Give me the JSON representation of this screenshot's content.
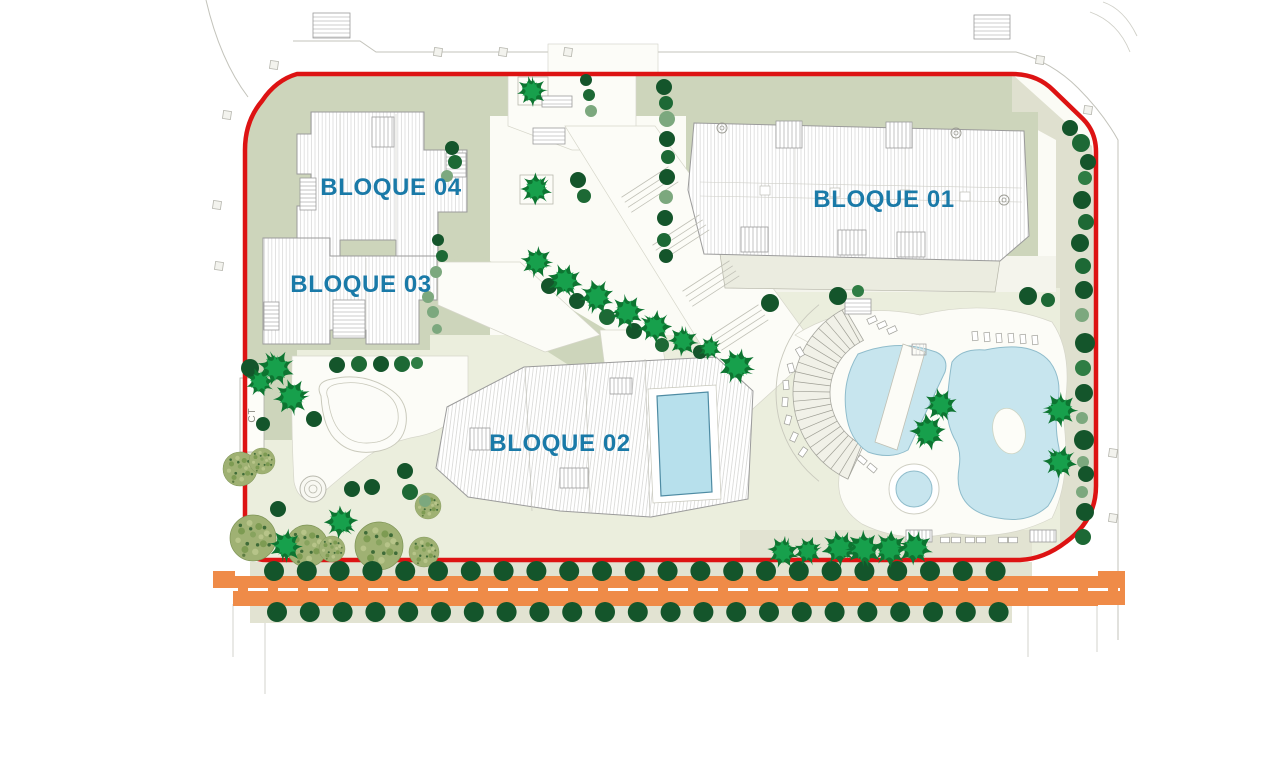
{
  "labels": {
    "bloque01": "BLOQUE 01",
    "bloque02": "BLOQUE 02",
    "bloque03": "BLOQUE 03",
    "bloque04": "BLOQUE 04",
    "ct": "CT"
  },
  "colors": {
    "boundary_red": "#dd1313",
    "road_orange": "#ef8b48",
    "label_blue": "#1a7aa8",
    "sage_green": "#cdd5bb",
    "lawn_green": "#ebeedd",
    "paving_beige": "#e2e3d2",
    "pool_blue": "#c7e5ee",
    "indoor_pool_blue": "#b7e0ec",
    "tree_palette": [
      "#14552b",
      "#1d6935",
      "#2f7d44",
      "#7ca87e"
    ],
    "palm_green": "#17a04c",
    "olive_green": "#9fb173"
  },
  "trees": {
    "round": [
      [
        1070,
        128,
        8,
        0
      ],
      [
        1081,
        143,
        9,
        1
      ],
      [
        1088,
        162,
        8,
        0
      ],
      [
        1085,
        178,
        7,
        2
      ],
      [
        1082,
        200,
        9,
        0
      ],
      [
        1086,
        222,
        8,
        1
      ],
      [
        1080,
        243,
        9,
        0
      ],
      [
        1083,
        266,
        8,
        1
      ],
      [
        1084,
        290,
        9,
        0
      ],
      [
        1082,
        315,
        7,
        3
      ],
      [
        1085,
        343,
        10,
        0
      ],
      [
        1083,
        368,
        8,
        2
      ],
      [
        1084,
        393,
        9,
        0
      ],
      [
        1082,
        418,
        6,
        3
      ],
      [
        1084,
        440,
        10,
        0
      ],
      [
        1083,
        462,
        6,
        3
      ],
      [
        1086,
        474,
        8,
        0
      ],
      [
        1082,
        492,
        6,
        3
      ],
      [
        1085,
        512,
        9,
        0
      ],
      [
        1083,
        537,
        8,
        1
      ],
      [
        664,
        87,
        8,
        0
      ],
      [
        666,
        103,
        7,
        1
      ],
      [
        667,
        119,
        8,
        3
      ],
      [
        667,
        139,
        8,
        0
      ],
      [
        668,
        157,
        7,
        1
      ],
      [
        667,
        177,
        8,
        0
      ],
      [
        666,
        197,
        7,
        3
      ],
      [
        665,
        218,
        8,
        0
      ],
      [
        664,
        240,
        7,
        1
      ],
      [
        666,
        256,
        7,
        0
      ],
      [
        586,
        80,
        6,
        0
      ],
      [
        589,
        95,
        6,
        1
      ],
      [
        591,
        111,
        6,
        3
      ],
      [
        578,
        180,
        8,
        0
      ],
      [
        584,
        196,
        7,
        1
      ],
      [
        452,
        148,
        7,
        0
      ],
      [
        455,
        162,
        7,
        1
      ],
      [
        447,
        176,
        6,
        3
      ],
      [
        438,
        240,
        6,
        0
      ],
      [
        442,
        256,
        6,
        1
      ],
      [
        436,
        272,
        6,
        3
      ],
      [
        428,
        297,
        6,
        3
      ],
      [
        433,
        312,
        6,
        3
      ],
      [
        437,
        329,
        5,
        3
      ],
      [
        549,
        286,
        8,
        0
      ],
      [
        577,
        301,
        8,
        0
      ],
      [
        607,
        317,
        8,
        1
      ],
      [
        634,
        331,
        8,
        0
      ],
      [
        662,
        345,
        7,
        1
      ],
      [
        700,
        352,
        7,
        0
      ],
      [
        770,
        303,
        9,
        0
      ],
      [
        838,
        296,
        9,
        0
      ],
      [
        858,
        291,
        6,
        2
      ],
      [
        1028,
        296,
        9,
        0
      ],
      [
        1048,
        300,
        7,
        1
      ],
      [
        250,
        368,
        9,
        0
      ],
      [
        337,
        365,
        8,
        0
      ],
      [
        359,
        364,
        8,
        1
      ],
      [
        381,
        364,
        8,
        0
      ],
      [
        402,
        364,
        8,
        1
      ],
      [
        417,
        363,
        6,
        2
      ],
      [
        314,
        419,
        8,
        0
      ],
      [
        263,
        424,
        7,
        0
      ],
      [
        352,
        489,
        8,
        0
      ],
      [
        372,
        487,
        8,
        0
      ],
      [
        405,
        471,
        8,
        0
      ],
      [
        410,
        492,
        8,
        1
      ],
      [
        425,
        501,
        6,
        3
      ],
      [
        278,
        509,
        8,
        0
      ]
    ],
    "rows": {
      "y": [
        571,
        612
      ],
      "x_start": [
        274,
        277
      ],
      "step": 32.8,
      "count": 23,
      "r": 10,
      "color_index": 0
    },
    "palms": [
      [
        532,
        91,
        1.0
      ],
      [
        536,
        189,
        1.05
      ],
      [
        537,
        262,
        1.05
      ],
      [
        565,
        281,
        1.15
      ],
      [
        597,
        297,
        1.15
      ],
      [
        627,
        312,
        1.15
      ],
      [
        655,
        327,
        1.1
      ],
      [
        683,
        341,
        1.0
      ],
      [
        710,
        348,
        0.8
      ],
      [
        737,
        366,
        1.2
      ],
      [
        941,
        405,
        1.1
      ],
      [
        928,
        432,
        1.2
      ],
      [
        1060,
        410,
        1.15
      ],
      [
        1060,
        462,
        1.1
      ],
      [
        783,
        552,
        1.05
      ],
      [
        808,
        551,
        0.95
      ],
      [
        840,
        548,
        1.2
      ],
      [
        864,
        549,
        1.2
      ],
      [
        890,
        549,
        1.2
      ],
      [
        915,
        548,
        1.15
      ],
      [
        276,
        368,
        1.2
      ],
      [
        260,
        382,
        0.95
      ],
      [
        292,
        397,
        1.2
      ],
      [
        341,
        522,
        1.1
      ],
      [
        286,
        546,
        1.1
      ]
    ],
    "textured": [
      [
        240,
        469,
        17
      ],
      [
        262,
        461,
        13
      ],
      [
        253,
        538,
        23
      ],
      [
        307,
        546,
        21
      ],
      [
        332,
        549,
        13
      ],
      [
        379,
        546,
        24
      ],
      [
        428,
        506,
        13
      ],
      [
        424,
        552,
        15
      ]
    ]
  },
  "furniture": {
    "stairs": [
      [
        313,
        13,
        37,
        25,
        "h"
      ],
      [
        974,
        15,
        36,
        24,
        "h"
      ],
      [
        776,
        121,
        26,
        27,
        "v"
      ],
      [
        886,
        122,
        26,
        26,
        "v"
      ],
      [
        741,
        227,
        27,
        25,
        "v"
      ],
      [
        838,
        230,
        28,
        25,
        "v"
      ],
      [
        897,
        232,
        28,
        25,
        "v"
      ],
      [
        372,
        117,
        22,
        30,
        "v"
      ],
      [
        300,
        178,
        16,
        32,
        "h"
      ],
      [
        446,
        153,
        20,
        24,
        "h"
      ],
      [
        333,
        300,
        32,
        38,
        "h"
      ],
      [
        264,
        302,
        15,
        28,
        "h"
      ],
      [
        560,
        468,
        28,
        20,
        "v"
      ],
      [
        610,
        378,
        22,
        16,
        "v"
      ],
      [
        470,
        428,
        20,
        22,
        "v"
      ],
      [
        542,
        96,
        30,
        11,
        "h"
      ],
      [
        533,
        128,
        32,
        16,
        "h"
      ],
      [
        845,
        299,
        26,
        15,
        "h"
      ],
      [
        906,
        530,
        26,
        12,
        "v"
      ],
      [
        1030,
        530,
        26,
        12,
        "v"
      ]
    ],
    "loungers": [
      [
        872,
        320,
        -25
      ],
      [
        882,
        325,
        -25
      ],
      [
        892,
        330,
        -25
      ],
      [
        975,
        336,
        85
      ],
      [
        987,
        337,
        85
      ],
      [
        999,
        338,
        85
      ],
      [
        1011,
        338,
        85
      ],
      [
        1023,
        339,
        85
      ],
      [
        1035,
        340,
        85
      ],
      [
        800,
        352,
        60
      ],
      [
        791,
        368,
        75
      ],
      [
        786,
        385,
        85
      ],
      [
        785,
        402,
        95
      ],
      [
        788,
        420,
        105
      ],
      [
        794,
        437,
        115
      ],
      [
        803,
        452,
        125
      ],
      [
        862,
        460,
        40
      ],
      [
        872,
        468,
        40
      ],
      [
        945,
        540,
        0
      ],
      [
        956,
        540,
        0
      ],
      [
        970,
        540,
        0
      ],
      [
        981,
        540,
        0
      ],
      [
        1003,
        540,
        0
      ],
      [
        1013,
        540,
        0
      ]
    ],
    "markers": [
      [
        274,
        65
      ],
      [
        227,
        115
      ],
      [
        438,
        52
      ],
      [
        503,
        52
      ],
      [
        568,
        52
      ],
      [
        1040,
        60
      ],
      [
        1088,
        110
      ],
      [
        1113,
        453
      ],
      [
        1113,
        518
      ],
      [
        217,
        205
      ],
      [
        219,
        266
      ]
    ],
    "spirals": [
      [
        722,
        128
      ],
      [
        956,
        133
      ],
      [
        1004,
        200
      ]
    ]
  },
  "amphitheater": {
    "cx": 888,
    "cy": 393,
    "r_inner": 58,
    "r_outer": 95,
    "a_start": 115,
    "a_end": 245,
    "step": 6
  }
}
